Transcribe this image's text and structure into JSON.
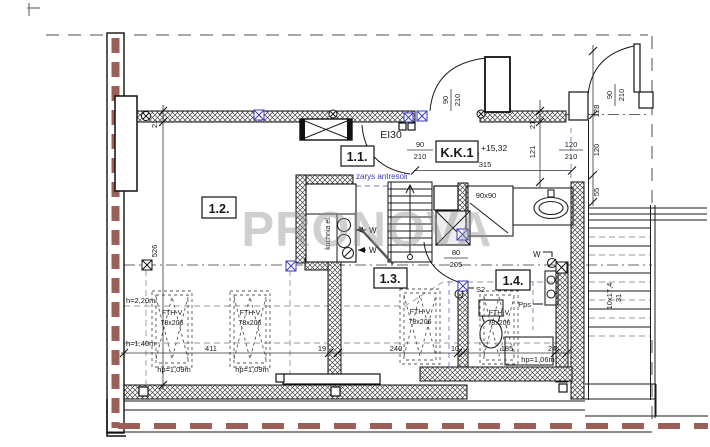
{
  "watermark": {
    "text": "PRONOVA"
  },
  "rooms": {
    "r11": "1.1.",
    "r12": "1.2.",
    "r13": "1.3.",
    "r14": "1.4.",
    "kk1": "K.K.1"
  },
  "annotations": {
    "mezzanine": "zarys antresoli",
    "fire_rating": "EI30",
    "level": "+15,32",
    "kitchen": "kuchnia el.",
    "water": "W",
    "s2": "S2",
    "pps": "Pps",
    "shower_size": "90x90",
    "stair_run": "10x17,4",
    "stair_width": "31"
  },
  "roof_windows": {
    "model": "FTH-V",
    "size": "78x206",
    "hp_109": "hp=1,09m",
    "hp_106": "hp=1,06m"
  },
  "height_lines": {
    "h220": "h=2,20m",
    "h140": "h=1,40m"
  },
  "door_sizes": {
    "w90": "90",
    "h210": "210",
    "w80": "80",
    "h205": "205",
    "w120": "120"
  },
  "dimensions": {
    "wall_21": "21",
    "room_526": "526",
    "room_121": "121",
    "opening_128": "128",
    "seg_120": "120",
    "seg_55": "55",
    "width_315": "315",
    "w411": "411",
    "w19": "19",
    "w240": "240",
    "w10": "10",
    "w185": "185",
    "w24": "24"
  },
  "colors": {
    "fire_wall_red": "#9c5f58",
    "marker_blue": "#3a3ac0",
    "mezzanine_blue": "#3a3ab8",
    "watermark_gray": "#8f8f8f"
  }
}
